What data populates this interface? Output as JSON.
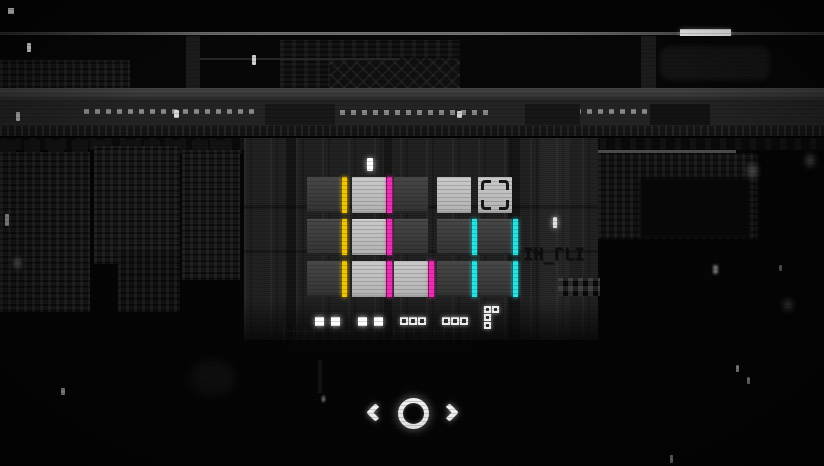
{
  "colors": {
    "yellow": "#f2c400",
    "magenta": "#f02cb6",
    "cyan": "#27e2e2",
    "tile_light": "#bdbdbd",
    "tile_dark": "#3b3b3b",
    "background": "#050505",
    "glow_white": "#f5f5f5"
  },
  "topbar": {
    "menu_icon_cells": [
      "#3c3c3c",
      "#8e8e8e",
      "#272727",
      "#9e9e9e",
      "#ffffff",
      "#3a3a3a",
      "#2b2b2b",
      "#9a9a9a",
      "#e6e6e6"
    ],
    "progress_bar": {
      "x": 680,
      "width": 51
    }
  },
  "board": {
    "cols_x": [
      307,
      352,
      394,
      437,
      478
    ],
    "rows_y": [
      177,
      219,
      261
    ],
    "tile_w": 34,
    "tile_h": 36,
    "stripe_w": 5,
    "tiles": [
      {
        "r": 0,
        "c": 0,
        "shade": "dark",
        "stripe": "yellow",
        "bracket": false
      },
      {
        "r": 0,
        "c": 1,
        "shade": "light",
        "stripe": "magenta",
        "bracket": false
      },
      {
        "r": 0,
        "c": 2,
        "shade": "dark",
        "stripe": null,
        "bracket": false
      },
      {
        "r": 0,
        "c": 3,
        "shade": "light",
        "stripe": null,
        "bracket": false
      },
      {
        "r": 0,
        "c": 4,
        "shade": "light",
        "stripe": null,
        "bracket": true
      },
      {
        "r": 1,
        "c": 0,
        "shade": "dark",
        "stripe": "yellow",
        "bracket": false
      },
      {
        "r": 1,
        "c": 1,
        "shade": "light",
        "stripe": "magenta",
        "bracket": false
      },
      {
        "r": 1,
        "c": 2,
        "shade": "dark",
        "stripe": null,
        "bracket": false
      },
      {
        "r": 1,
        "c": 3,
        "shade": "dark",
        "stripe": "cyan",
        "bracket": false
      },
      {
        "r": 1,
        "c": 4,
        "shade": "dark",
        "stripe": "cyan",
        "bracket": false
      },
      {
        "r": 2,
        "c": 0,
        "shade": "dark",
        "stripe": "yellow",
        "bracket": false
      },
      {
        "r": 2,
        "c": 1,
        "shade": "light",
        "stripe": "magenta",
        "bracket": false
      },
      {
        "r": 2,
        "c": 2,
        "shade": "light",
        "stripe": "magenta",
        "bracket": false
      },
      {
        "r": 2,
        "c": 3,
        "shade": "dark",
        "stripe": "cyan",
        "bracket": false
      },
      {
        "r": 2,
        "c": 4,
        "shade": "dark",
        "stripe": "cyan",
        "bracket": false
      }
    ]
  },
  "indicators": [
    {
      "style": "solid",
      "size": 9,
      "cells": [
        [
          315,
          317
        ],
        [
          331,
          317
        ]
      ]
    },
    {
      "style": "solid",
      "size": 9,
      "cells": [
        [
          358,
          317
        ],
        [
          374,
          317
        ]
      ]
    },
    {
      "style": "hollow",
      "size": 8,
      "cells": [
        [
          400,
          317
        ],
        [
          409,
          317
        ],
        [
          418,
          317
        ]
      ]
    },
    {
      "style": "hollow",
      "size": 8,
      "cells": [
        [
          442,
          317
        ],
        [
          451,
          317
        ],
        [
          460,
          317
        ]
      ]
    },
    {
      "style": "hollow",
      "size": 7,
      "cells": [
        [
          484,
          306
        ],
        [
          492,
          306
        ],
        [
          484,
          314
        ],
        [
          484,
          322
        ]
      ]
    }
  ],
  "glitch_text": {
    "value": "IH_ГLI",
    "x": 523,
    "y": 245
  },
  "nav": {
    "prev": "chevron-left",
    "center": "circle-button",
    "next": "chevron-right"
  },
  "specks": [
    {
      "x": 27,
      "y": 43,
      "w": 4,
      "h": 9,
      "color": "#e8e8e8",
      "blur": 0,
      "glow": false
    },
    {
      "x": 252,
      "y": 55,
      "w": 4,
      "h": 10,
      "color": "#cfcfcf",
      "blur": 0,
      "glow": false
    },
    {
      "x": 16,
      "y": 112,
      "w": 4,
      "h": 9,
      "color": "#b0b0b0",
      "blur": 0,
      "glow": false
    },
    {
      "x": 174,
      "y": 110,
      "w": 5,
      "h": 8,
      "color": "#d8d8d8",
      "blur": 0,
      "glow": false
    },
    {
      "x": 457,
      "y": 111,
      "w": 5,
      "h": 7,
      "color": "#cfcfcf",
      "blur": 0,
      "glow": false
    },
    {
      "x": 367,
      "y": 158,
      "w": 6,
      "h": 13,
      "color": "#ffffff",
      "blur": 0,
      "glow": true
    },
    {
      "x": 553,
      "y": 217,
      "w": 4,
      "h": 11,
      "color": "#e0e0e0",
      "blur": 0,
      "glow": true
    },
    {
      "x": 5,
      "y": 214,
      "w": 4,
      "h": 12,
      "color": "#8a8a8a",
      "blur": 0,
      "glow": false
    },
    {
      "x": 14,
      "y": 258,
      "w": 7,
      "h": 10,
      "color": "#4a4a4a",
      "blur": 2,
      "glow": false
    },
    {
      "x": 61,
      "y": 388,
      "w": 4,
      "h": 7,
      "color": "#9a9a9a",
      "blur": 0,
      "glow": false
    },
    {
      "x": 322,
      "y": 396,
      "w": 3,
      "h": 6,
      "color": "#777777",
      "blur": 1,
      "glow": false
    },
    {
      "x": 748,
      "y": 165,
      "w": 9,
      "h": 12,
      "color": "#4a4a4a",
      "blur": 3,
      "glow": false
    },
    {
      "x": 806,
      "y": 155,
      "w": 8,
      "h": 11,
      "color": "#3f3f3f",
      "blur": 3,
      "glow": false
    },
    {
      "x": 713,
      "y": 265,
      "w": 5,
      "h": 9,
      "color": "#6a6a6a",
      "blur": 1,
      "glow": false
    },
    {
      "x": 779,
      "y": 265,
      "w": 3,
      "h": 6,
      "color": "#555555",
      "blur": 0,
      "glow": false
    },
    {
      "x": 784,
      "y": 300,
      "w": 8,
      "h": 10,
      "color": "#333333",
      "blur": 3,
      "glow": false
    },
    {
      "x": 736,
      "y": 365,
      "w": 3,
      "h": 7,
      "color": "#888888",
      "blur": 0,
      "glow": false
    },
    {
      "x": 747,
      "y": 377,
      "w": 3,
      "h": 7,
      "color": "#777777",
      "blur": 0,
      "glow": false
    },
    {
      "x": 670,
      "y": 455,
      "w": 3,
      "h": 8,
      "color": "#7a7a7a",
      "blur": 0,
      "glow": false
    }
  ]
}
